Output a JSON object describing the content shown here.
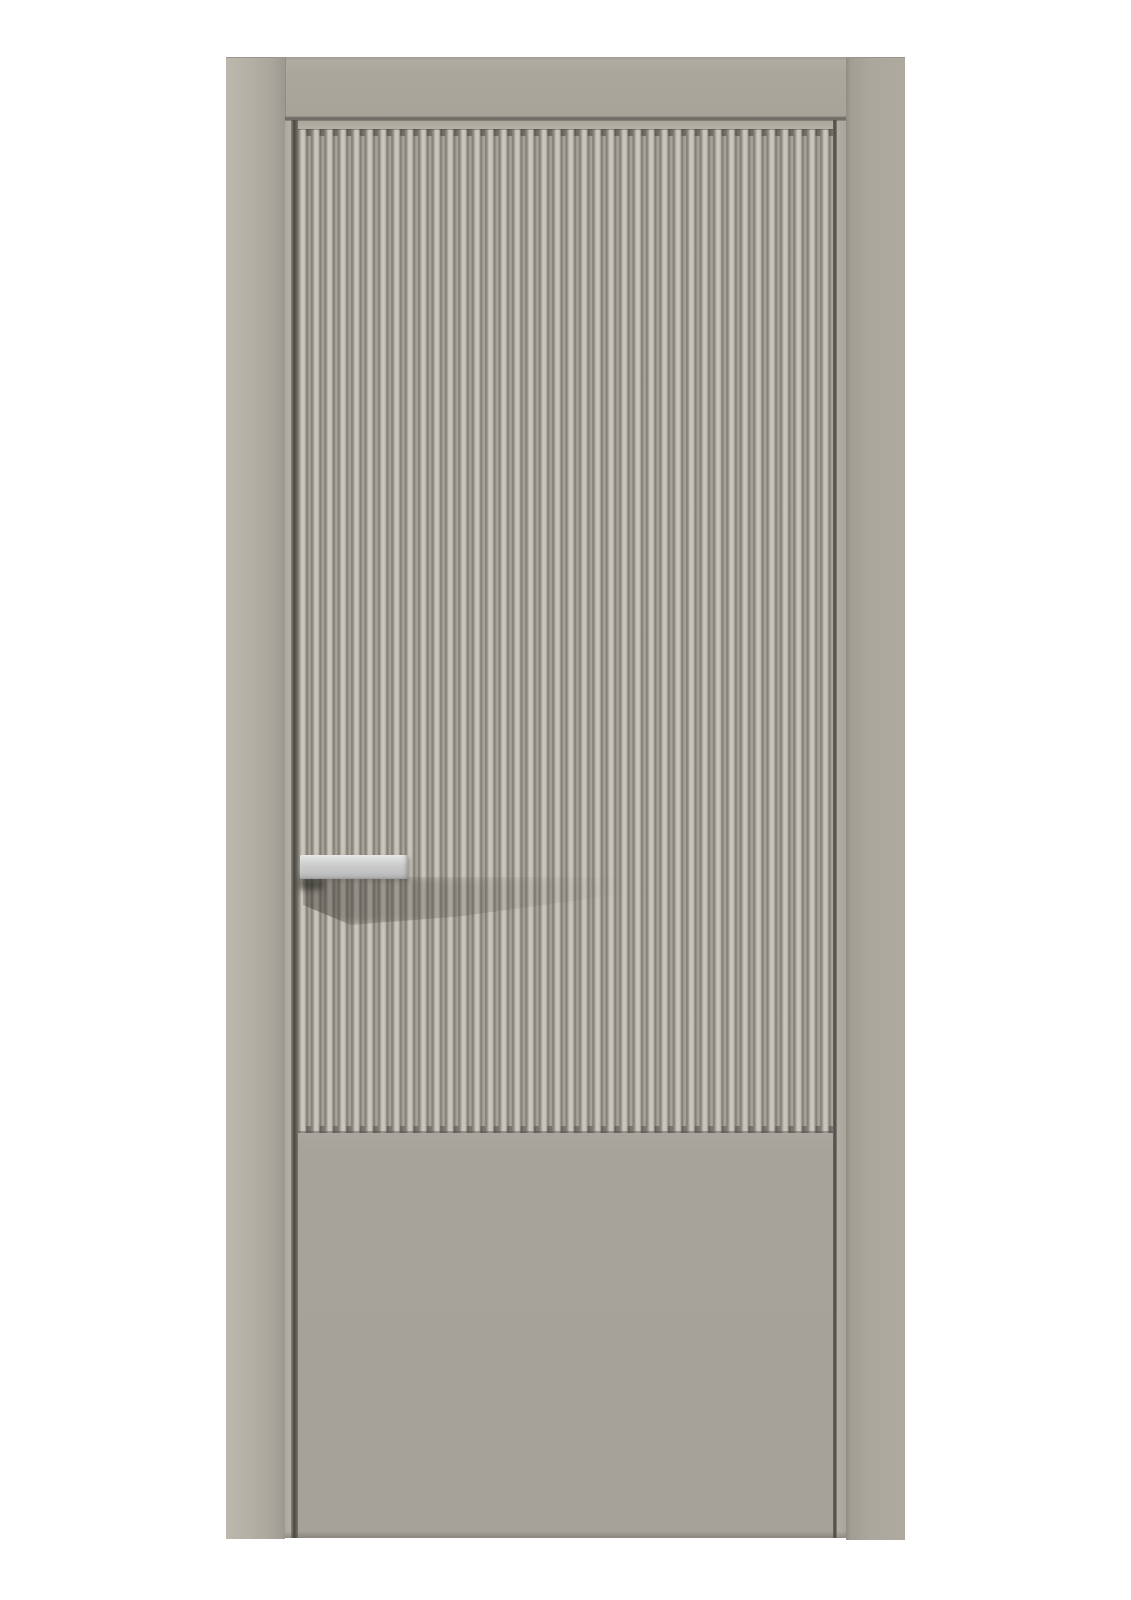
{
  "scene": {
    "description": "Product photograph of a closed modern interior door, front view, centered on a plain white background. The door leaf has a tall recessed panel of fine vertical fluting (reeded slats) over a plain flat lower panel, all in a matte warm-gray greige finish, set inside a matching flat architrave frame. A rectangular satin-silver bar handle projects from the left edge at mid height and casts a soft diagonal shadow across the flutes.",
    "background_color": "#ffffff"
  },
  "door": {
    "finish": "matte greige (warm gray)",
    "frame": {
      "parts": [
        "left casing strip",
        "head casing",
        "right casing strip"
      ],
      "color": "#aba79d"
    },
    "leaf": {
      "upper_panel": "vertical fluted / reeded texture, ~40 narrow slats",
      "lower_panel": "flat smooth panel",
      "top_rail": "narrow flat rail under head casing",
      "edge_gaps": "dark shadow gap lines at both leaf edges",
      "color": "#a7a39a"
    },
    "handle": {
      "type": "rectangular bar pull",
      "finish": "satin silver",
      "placement": "left edge, mid height",
      "color": "#c9c9c9"
    }
  },
  "palette": {
    "background": "#ffffff",
    "frame": "#aba79d",
    "frame_light": "#b5b1a7",
    "leaf": "#a7a39a",
    "rail": "#b5b1a7",
    "flute_ridge": "#c7c3b9",
    "flute_groove": "#aaa69c",
    "flute_dark": "#817e77",
    "gap_dark": "#4a4742",
    "handle": "#c9c9c9",
    "handle_highlight": "#eceded"
  }
}
